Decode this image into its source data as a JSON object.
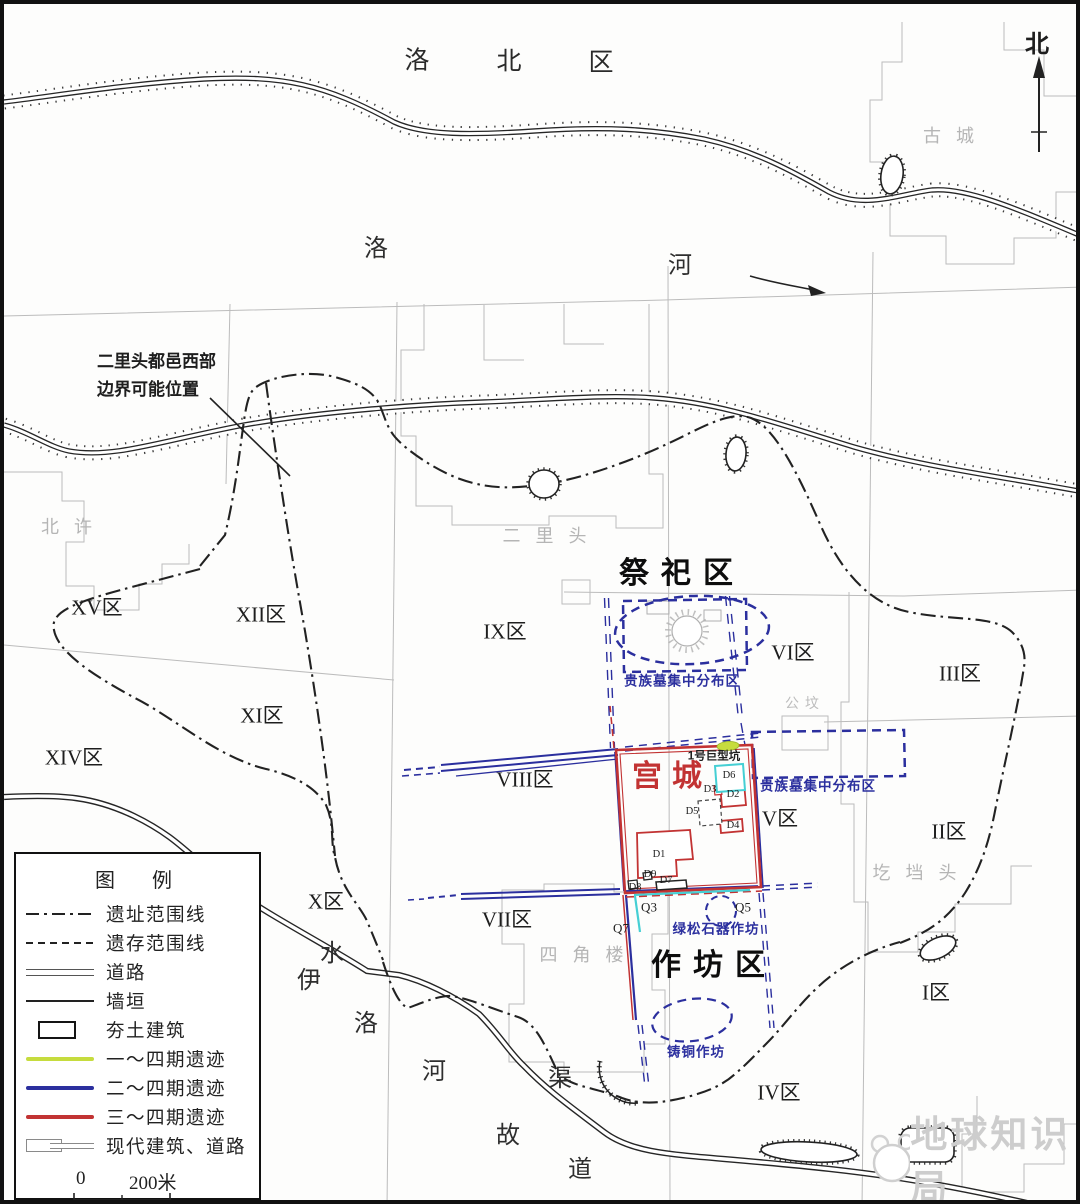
{
  "colors": {
    "phase1_green": "#c6dc3e",
    "phase2_blue": "#2b2f9e",
    "phase3_red": "#c23333",
    "cyan_accent": "#45cfd4",
    "cadastral_gray": "#bcbcbc",
    "label_gray": "#b5b5b5",
    "map_black": "#222222"
  },
  "compass": {
    "label": "北"
  },
  "watermark": {
    "text": "地球知识局"
  },
  "legend": {
    "title": "图  例",
    "rows": [
      {
        "symbol": "dashdot",
        "label": "遗址范围线"
      },
      {
        "symbol": "dashed",
        "label": "遗存范围线"
      },
      {
        "symbol": "road",
        "label": "道路"
      },
      {
        "symbol": "solid",
        "label": "墙垣"
      },
      {
        "symbol": "rect",
        "label": "夯土建筑"
      },
      {
        "symbol": "green",
        "label": "一～四期遗迹"
      },
      {
        "symbol": "blue",
        "label": "二～四期遗迹"
      },
      {
        "symbol": "red",
        "label": "三～四期遗迹"
      },
      {
        "symbol": "modern",
        "label": "现代建筑、道路"
      }
    ],
    "scale": {
      "start": "0",
      "end": "200米"
    }
  },
  "labels": [
    {
      "name": "district-char-luo",
      "text": "洛",
      "x": 413,
      "y": 57,
      "cls": "district"
    },
    {
      "name": "district-char-bei",
      "text": "北",
      "x": 505,
      "y": 58,
      "cls": "district"
    },
    {
      "name": "district-char-qu",
      "text": "区",
      "x": 597,
      "y": 59,
      "cls": "district"
    },
    {
      "name": "north-label",
      "text": "北",
      "x": 1033,
      "y": 41,
      "cls": "north"
    },
    {
      "name": "gray-name-gucheng",
      "text": "古城",
      "x": 952,
      "y": 132,
      "cls": "gray"
    },
    {
      "name": "river-char-luo-top",
      "text": "洛",
      "x": 372,
      "y": 245,
      "cls": "river"
    },
    {
      "name": "river-char-he-top",
      "text": "河",
      "x": 676,
      "y": 262,
      "cls": "river"
    },
    {
      "name": "boundary-annotation",
      "text": "二里头都邑西部\n边界可能位置",
      "x": 93,
      "y": 344,
      "cls": "anno",
      "tl": true
    },
    {
      "name": "gray-name-beixu",
      "text": "北许",
      "x": 70,
      "y": 523,
      "cls": "gray"
    },
    {
      "name": "gray-name-erlitou",
      "text": "二里头",
      "x": 548,
      "y": 532,
      "cls": "gray"
    },
    {
      "name": "zone-label-xv",
      "text": "XV区",
      "x": 93,
      "y": 604,
      "cls": "zone"
    },
    {
      "name": "zone-label-xii",
      "text": "XII区",
      "x": 257,
      "y": 611,
      "cls": "zone"
    },
    {
      "name": "zone-label-ix",
      "text": "IX区",
      "x": 501,
      "y": 628,
      "cls": "zone"
    },
    {
      "name": "sacrificial-area-title",
      "text": "祭祀区",
      "x": 678,
      "y": 570,
      "cls": "big"
    },
    {
      "name": "zone-label-vi",
      "text": "VI区",
      "x": 789,
      "y": 649,
      "cls": "zone"
    },
    {
      "name": "zone-label-iii",
      "text": "III区",
      "x": 956,
      "y": 670,
      "cls": "zone"
    },
    {
      "name": "noble-tombs-label-north",
      "text": "贵族墓集中分布区",
      "x": 678,
      "y": 677,
      "cls": "blue"
    },
    {
      "name": "gray-name-gongfen",
      "text": "公坟",
      "x": 801,
      "y": 701,
      "cls": "gray-sm"
    },
    {
      "name": "zone-label-xi",
      "text": "XI区",
      "x": 258,
      "y": 712,
      "cls": "zone"
    },
    {
      "name": "zone-label-xiv",
      "text": "XIV区",
      "x": 70,
      "y": 754,
      "cls": "zone"
    },
    {
      "name": "zone-label-viii",
      "text": "VIII区",
      "x": 521,
      "y": 776,
      "cls": "zone"
    },
    {
      "name": "palace-city-title",
      "text": "宫城",
      "x": 668,
      "y": 773,
      "cls": "big-red"
    },
    {
      "name": "giant-pit-label",
      "text": "1号巨型坑",
      "x": 710,
      "y": 753,
      "cls": "pit"
    },
    {
      "name": "noble-tombs-label-east",
      "text": "贵族墓集中分布区",
      "x": 814,
      "y": 782,
      "cls": "blue"
    },
    {
      "name": "building-label-d6",
      "text": "D6",
      "x": 725,
      "y": 772,
      "cls": "d"
    },
    {
      "name": "building-label-d3",
      "text": "D3",
      "x": 706,
      "y": 786,
      "cls": "d"
    },
    {
      "name": "building-label-d2",
      "text": "D2",
      "x": 729,
      "y": 791,
      "cls": "d"
    },
    {
      "name": "building-label-d5",
      "text": "D5",
      "x": 688,
      "y": 808,
      "cls": "d"
    },
    {
      "name": "building-label-d4",
      "text": "D4",
      "x": 729,
      "y": 822,
      "cls": "d"
    },
    {
      "name": "zone-label-v",
      "text": "V区",
      "x": 776,
      "y": 815,
      "cls": "zone"
    },
    {
      "name": "zone-label-ii",
      "text": "II区",
      "x": 945,
      "y": 828,
      "cls": "zone"
    },
    {
      "name": "gray-name-gedangtou",
      "text": "圪垱头",
      "x": 918,
      "y": 869,
      "cls": "gray"
    },
    {
      "name": "building-label-d1",
      "text": "D1",
      "x": 655,
      "y": 851,
      "cls": "d"
    },
    {
      "name": "building-label-d9",
      "text": "D9",
      "x": 646,
      "y": 871,
      "cls": "d"
    },
    {
      "name": "building-label-d7",
      "text": "D7",
      "x": 662,
      "y": 877,
      "cls": "d"
    },
    {
      "name": "building-label-d8",
      "text": "D8",
      "x": 631,
      "y": 884,
      "cls": "d"
    },
    {
      "name": "zone-label-x",
      "text": "X区",
      "x": 322,
      "y": 898,
      "cls": "zone"
    },
    {
      "name": "zone-label-vii",
      "text": "VII区",
      "x": 503,
      "y": 916,
      "cls": "zone"
    },
    {
      "name": "feature-label-q3",
      "text": "Q3",
      "x": 645,
      "y": 903,
      "cls": "q"
    },
    {
      "name": "feature-label-q5",
      "text": "Q5",
      "x": 739,
      "y": 903,
      "cls": "q"
    },
    {
      "name": "feature-label-q7",
      "text": "Q7",
      "x": 617,
      "y": 924,
      "cls": "q"
    },
    {
      "name": "turquoise-workshop-label",
      "text": "绿松石器作坊",
      "x": 712,
      "y": 925,
      "cls": "blue"
    },
    {
      "name": "gray-name-sijiaolou",
      "text": "四角楼",
      "x": 585,
      "y": 951,
      "cls": "gray"
    },
    {
      "name": "workshop-area-title",
      "text": "作坊区",
      "x": 710,
      "y": 962,
      "cls": "big"
    },
    {
      "name": "river-char-shui",
      "text": "水",
      "x": 328,
      "y": 950,
      "cls": "river"
    },
    {
      "name": "river-char-yi",
      "text": "伊",
      "x": 305,
      "y": 977,
      "cls": "river"
    },
    {
      "name": "river-char-luo",
      "text": "洛",
      "x": 362,
      "y": 1020,
      "cls": "river"
    },
    {
      "name": "river-char-he",
      "text": "河",
      "x": 430,
      "y": 1068,
      "cls": "river"
    },
    {
      "name": "river-char-qu2",
      "text": "渠",
      "x": 556,
      "y": 1075,
      "cls": "river"
    },
    {
      "name": "river-char-gu",
      "text": "故",
      "x": 504,
      "y": 1132,
      "cls": "river"
    },
    {
      "name": "river-char-dao",
      "text": "道",
      "x": 576,
      "y": 1166,
      "cls": "river"
    },
    {
      "name": "bronze-workshop-label",
      "text": "铸铜作坊",
      "x": 692,
      "y": 1048,
      "cls": "blue"
    },
    {
      "name": "zone-label-iv",
      "text": "IV区",
      "x": 775,
      "y": 1089,
      "cls": "zone"
    },
    {
      "name": "zone-label-i",
      "text": "I区",
      "x": 932,
      "y": 989,
      "cls": "zone"
    }
  ]
}
